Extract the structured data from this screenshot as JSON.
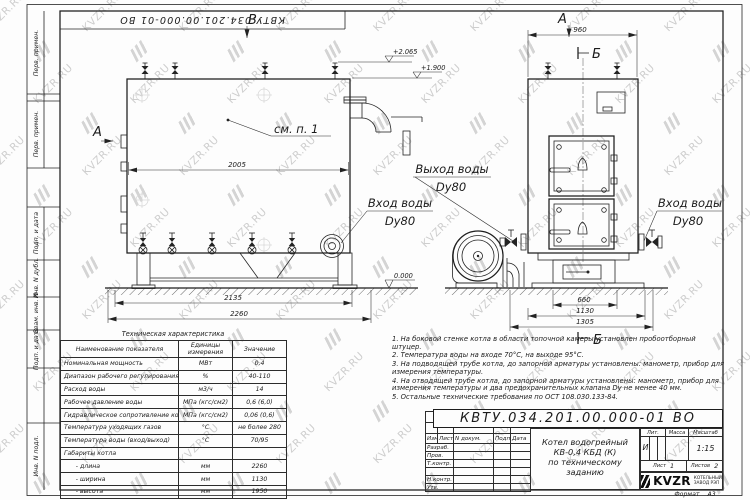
{
  "watermark": {
    "text": "KVZR.RU"
  },
  "frame": {
    "doc_number_rotated": "КВТУ.034.201.00.000-01 ВО",
    "side_labels": [
      "Перв. примен.",
      "Перв. примен.",
      "Подп. и дата",
      "Инв. N дубл.",
      "Взам. инв. N",
      "Подп. и дата",
      "Инв. N подл."
    ]
  },
  "views": {
    "view_label_a_front": "А",
    "view_label_b_top": "В",
    "view_label_a_side": "А",
    "section_label_top": "Б",
    "section_label_bottom": "Б",
    "see_item_note": "см. п. 1",
    "outlet_label": {
      "line1": "Выход воды",
      "line2": "Dу80"
    },
    "inlet_label_front": {
      "line1": "Вход воды",
      "line2": "Dу80"
    },
    "inlet_label_side": {
      "line1": "Вход воды",
      "line2": "Dу80"
    },
    "elevations": {
      "top": "+2.065",
      "mid": "+1.900",
      "zero": "0.000"
    },
    "dimensions": {
      "front_width": "2005",
      "front_base": "2135",
      "front_total": "2260",
      "side_top": "960",
      "side_base": "660",
      "side_mid": "1130",
      "side_total": "1305"
    }
  },
  "spec_table": {
    "title": "Техническая характеристика",
    "headers": [
      "Наименование показателя",
      "Единицы измерения",
      "Значение"
    ],
    "rows": [
      {
        "name": "Номинальная мощность",
        "unit": "МВт",
        "value": "0,4"
      },
      {
        "name": "Диапазон рабочего регулирования",
        "unit": "%",
        "value": "40-110"
      },
      {
        "name": "Расход воды",
        "unit": "м3/ч",
        "value": "14"
      },
      {
        "name": "Рабочее давление воды",
        "unit": "МПа (кгс/см2)",
        "value": "0,6 (6,0)"
      },
      {
        "name": "Гидравлическое сопротивление котла",
        "unit": "МПа (кгс/см2)",
        "value": "0,06 (0,6)"
      },
      {
        "name": "Температура уходящих газов",
        "unit": "°С",
        "value": "не более 280"
      },
      {
        "name": "Температура воды (вход/выход)",
        "unit": "°С",
        "value": "70/95"
      },
      {
        "name": "Габариты котла",
        "unit": "",
        "value": ""
      },
      {
        "name": "      - длина",
        "unit": "мм",
        "value": "2260"
      },
      {
        "name": "      - ширина",
        "unit": "мм",
        "value": "1130"
      },
      {
        "name": "      - высота",
        "unit": "мм",
        "value": "1950"
      }
    ]
  },
  "notes": {
    "items": [
      "1.  На боковой стенке котла в области топочной камеры установлен пробоотборный штуцер.",
      "2.  Температура воды на входе 70°С, на выходе 95°С.",
      "3.  На подводящей трубе котла, до запорной арматуры установлены: манометр, прибор для измерения температуры.",
      "4.  На отводящей трубе котла, до запорной арматуры установлены: манометр, прибор для измерения температуры и два предохранительных клапана Dу не менее 40 мм.",
      "5.  Остальные технические требования по ОСТ 108.030.133-84."
    ]
  },
  "title_block": {
    "doc_number": "КВТУ.034.201.00.000-01 ВО",
    "change_header": [
      "Изм.",
      "Лист",
      "N докум.",
      "Подп.",
      "Дата"
    ],
    "row_labels": [
      "Разраб.",
      "Пров.",
      "Т.контр.",
      "",
      "Н.контр.",
      "Утв."
    ],
    "product_title_lines": [
      "Котел водогрейный",
      "КВ-0,4  КБД  (К)",
      "по техническому заданию"
    ],
    "lit_label": "Лит.",
    "mass_label": "Масса",
    "scale_label": "Масштаб",
    "lit_value": "И",
    "scale_value": "1:15",
    "sheet_label": "Лист",
    "sheet_value": "1",
    "sheets_label": "Листов",
    "sheets_value": "2",
    "company": {
      "logo_text": "KVZR",
      "sub_line1": "КОТЕЛЬНЫЙ",
      "sub_line2": "ЗАВОД РЭП"
    },
    "format_label": "Формат",
    "format_value": "А3"
  }
}
